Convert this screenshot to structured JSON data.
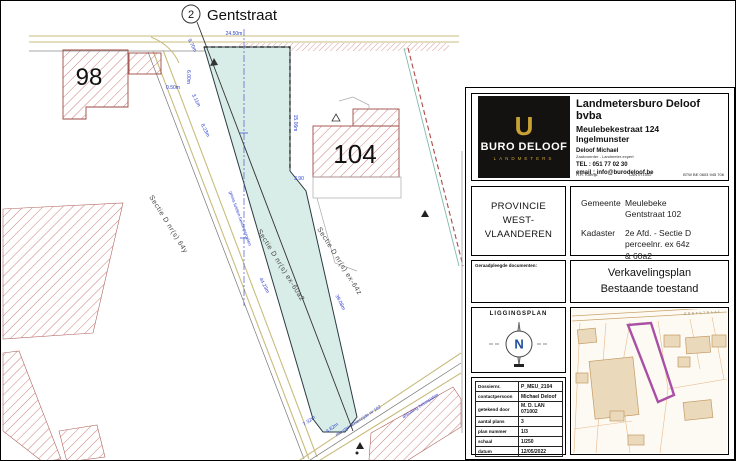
{
  "drawing": {
    "street": {
      "ref": "2",
      "name": "Gentstraat"
    },
    "parcel_98": "98",
    "parcel_104": "104",
    "sections": {
      "left": "Sectie D nr(s) 64y",
      "center": "Sectie D nr(s) ex-60a2",
      "right": "Sectie D nr(s) ex-64z"
    },
    "boundary_note": "grens tussen beide percelen",
    "wall_note": "muurtje achterzijde nr 102",
    "fence_note": "afsluiting betonpalen",
    "measurements": [
      "24.50m",
      "9.70m",
      "6.00m",
      "0.50m",
      "3.11m",
      "8.23m",
      "15.06m",
      "3,90",
      "44.23m",
      "39.08m",
      "7.32m",
      "4.62m"
    ]
  },
  "titleblock": {
    "firm": {
      "logo_monogram": "U",
      "logo_name": "BURO DELOOF",
      "logo_sub": "LANDMETERS",
      "name": "Landmetersburo Deloof bvba",
      "address1": "Meulebekestraat 124",
      "address2": "Ingelmunster",
      "contact_name": "Deloof Michael",
      "contact_role": "Zaakvoerder - Landmeter-expert",
      "tel": "TEL : 051 77 02 30",
      "email": "email : info@burodeloof.be",
      "reg1": "H.R. Kortrijk",
      "reg2": "LAN 071002",
      "reg3": "BTW BE 0603 945 706"
    },
    "province": {
      "line1": "PROVINCIE",
      "line2": "WEST-VLAANDEREN"
    },
    "location": {
      "gemeente_label": "Gemeente",
      "gemeente_line1": "Meulebeke",
      "gemeente_line2": "Gentstraat 102",
      "kadaster_label": "Kadaster",
      "kadaster_line1": "2e Afd. - Sectie D",
      "kadaster_line2": "perceelnr. ex 64z",
      "kadaster_line3": "& 60a2"
    },
    "docs_header": "Geraadpleegde documenten:",
    "plan_title": {
      "line1": "Verkavelingsplan",
      "line2": "Bestaande toestand"
    },
    "liggingsplan": {
      "label": "LIGGINGSPLAN",
      "north": "N"
    },
    "table": {
      "rows": [
        {
          "label": "Dossiernr.",
          "value": "P_MEU_2104"
        },
        {
          "label": "contactpersoon",
          "value": "Michael Deloof"
        },
        {
          "label": "getekend door",
          "value": "M. D. LAN 071002"
        },
        {
          "label": "aantal plans",
          "value": "3"
        },
        {
          "label": "plan nummer",
          "value": "1/3"
        },
        {
          "label": "schaal",
          "value": "1/250"
        },
        {
          "label": "datum",
          "value": "12/05/2022"
        }
      ]
    }
  },
  "minimap": {
    "street_name": "GENTSTRAAT"
  },
  "colors": {
    "parcel_fill": "#d9ede8",
    "hatch_red": "#c4706c",
    "road_tan": "#c9bc7e",
    "measure_blue": "#2b3fd0",
    "accent_gold": "#c9a235",
    "minimap_parcel_outline": "#a94fa4"
  }
}
